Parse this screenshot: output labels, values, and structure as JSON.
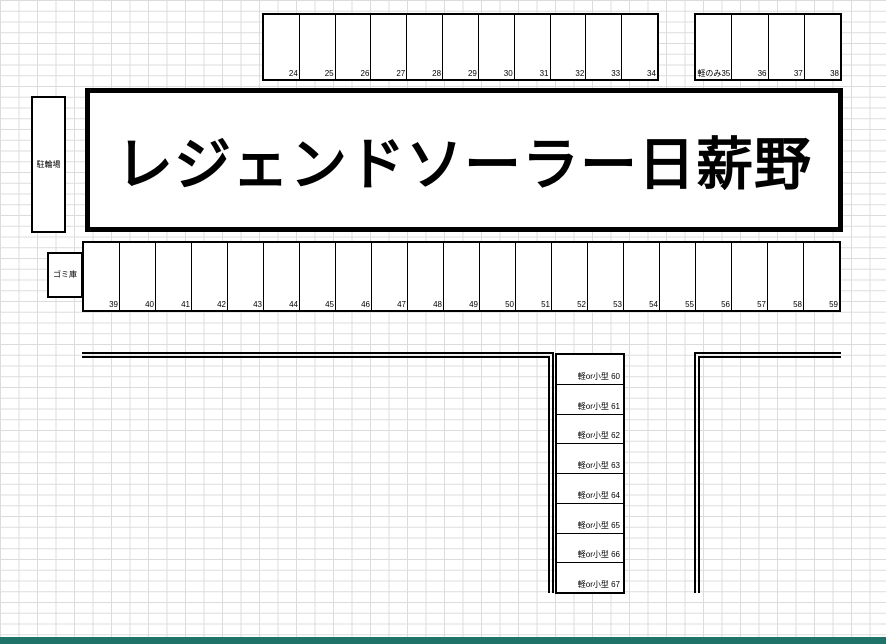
{
  "title": "レジェンドソーラー日薪野",
  "labels": {
    "bicycle_shed": "駐輪場",
    "garbage_shed": "ゴミ庫"
  },
  "parking": {
    "row_top": {
      "spaces": [
        "24",
        "25",
        "26",
        "27",
        "28",
        "29",
        "30",
        "31",
        "32",
        "33",
        "34"
      ]
    },
    "row_top_kei": {
      "spaces": [
        "軽のみ35",
        "36",
        "37",
        "38"
      ]
    },
    "row_middle": {
      "spaces": [
        "39",
        "40",
        "41",
        "42",
        "43",
        "44",
        "45",
        "46",
        "47",
        "48",
        "49",
        "50",
        "51",
        "52",
        "53",
        "54",
        "55",
        "56",
        "57",
        "58",
        "59"
      ]
    },
    "column_small": {
      "spaces": [
        "軽or小型 60",
        "軽or小型 61",
        "軽or小型 62",
        "軽or小型 63",
        "軽or小型 64",
        "軽or小型 65",
        "軽or小型 66",
        "軽or小型 67"
      ]
    }
  },
  "colors": {
    "line": "#000000",
    "grid_line": "#dcdcdc",
    "background": "#ffffff",
    "status_bar": "#1f7368"
  }
}
